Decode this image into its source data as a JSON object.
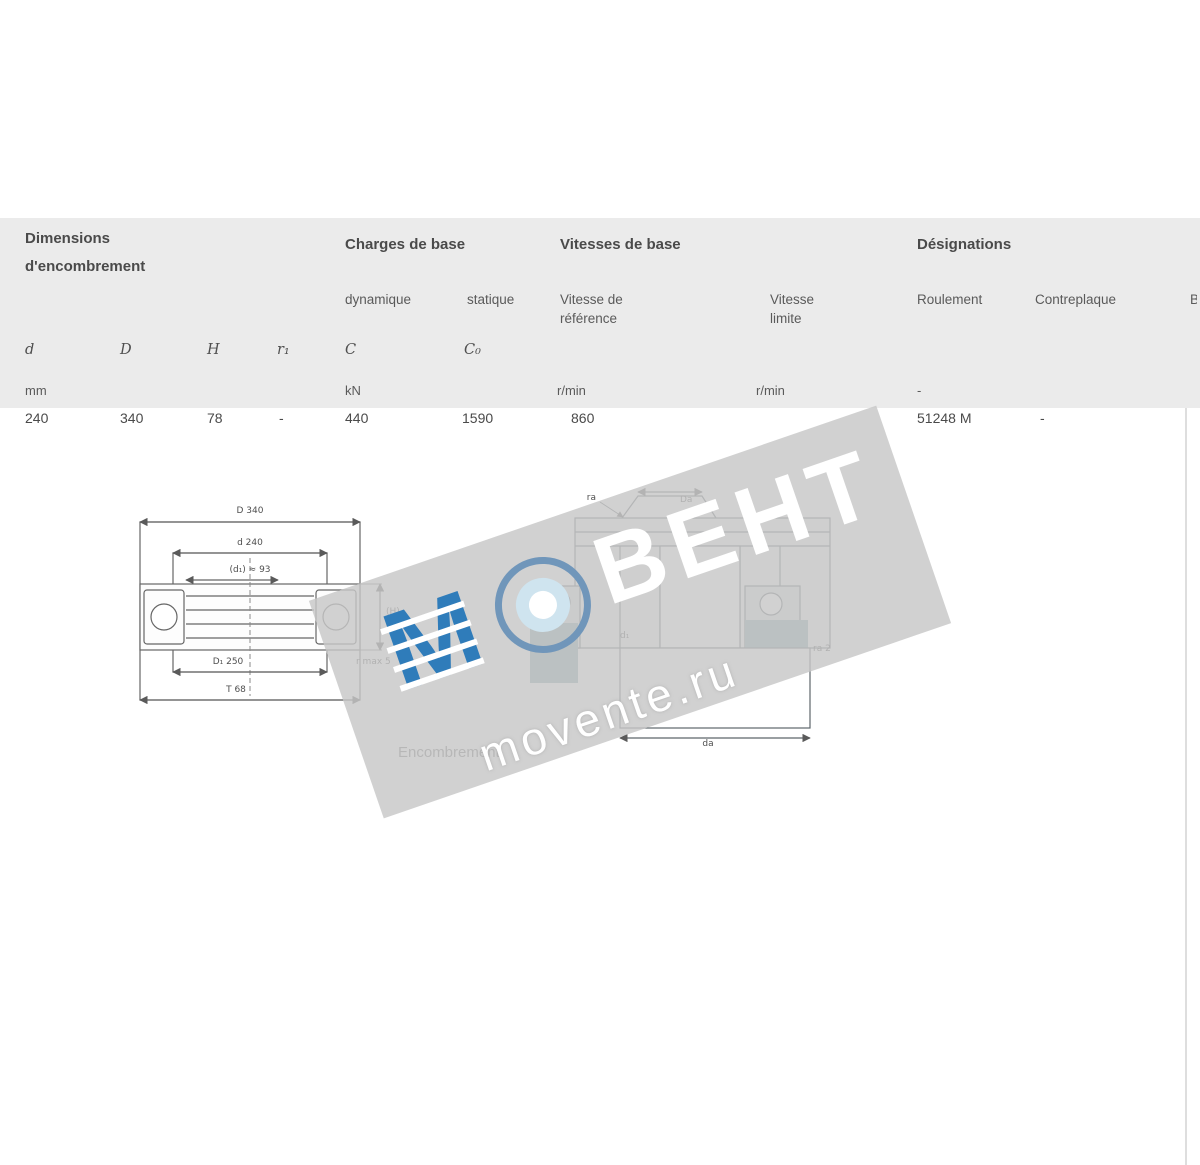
{
  "header": {
    "dimensions": {
      "title": "Dimensions",
      "subtitle": "d'encombrement"
    },
    "loads": {
      "title": "Charges de base",
      "dynamic": "dynamique",
      "static": "statique"
    },
    "speeds": {
      "title": "Vitesses de base",
      "ref1": "Vitesse de",
      "ref2": "référence",
      "lim1": "Vitesse",
      "lim2": "limite"
    },
    "designations": {
      "title": "Désignations",
      "bearing": "Roulement",
      "washer": "Contreplaque",
      "partial": "B"
    }
  },
  "columns": {
    "d": "d",
    "D": "D",
    "H": "H",
    "r1": "r₁",
    "C": "C",
    "C0": "C₀"
  },
  "units": {
    "mm": "mm",
    "kn": "kN",
    "rmin_ref": "r/min",
    "rmin_lim": "r/min",
    "desig": "-"
  },
  "row": {
    "d": "240",
    "D": "340",
    "H": "78",
    "r1": "-",
    "C": "440",
    "C0": "1590",
    "v_ref": "860",
    "bearing": "51248 M",
    "washer": "-"
  },
  "diagram_left": {
    "caption": "Encombrement",
    "dim_top_outer": "D 340",
    "dim_top_inner": "d 240",
    "dim_mid": "(d₁) ≈ 93",
    "dim_bot_inner": "D₁ 250",
    "dim_bot_outer": "T 68",
    "dim_height": "(H)",
    "dim_side": "r max 5"
  },
  "diagram_right": {
    "label_top_left": "ra",
    "label_top_center": "Da",
    "label_center": "d₁",
    "label_bottom": "da",
    "label_right": "ra 2"
  },
  "watermark": {
    "logo_letter": "M",
    "brand": "ВЕНТ",
    "site": "movente.ru",
    "colors": {
      "band": "#c7c7c7",
      "logo_blue": "#2f7cba",
      "ring_outer": "#7096ba",
      "ring_inner": "#cfe4ef",
      "teal": "#85a7ad"
    }
  }
}
